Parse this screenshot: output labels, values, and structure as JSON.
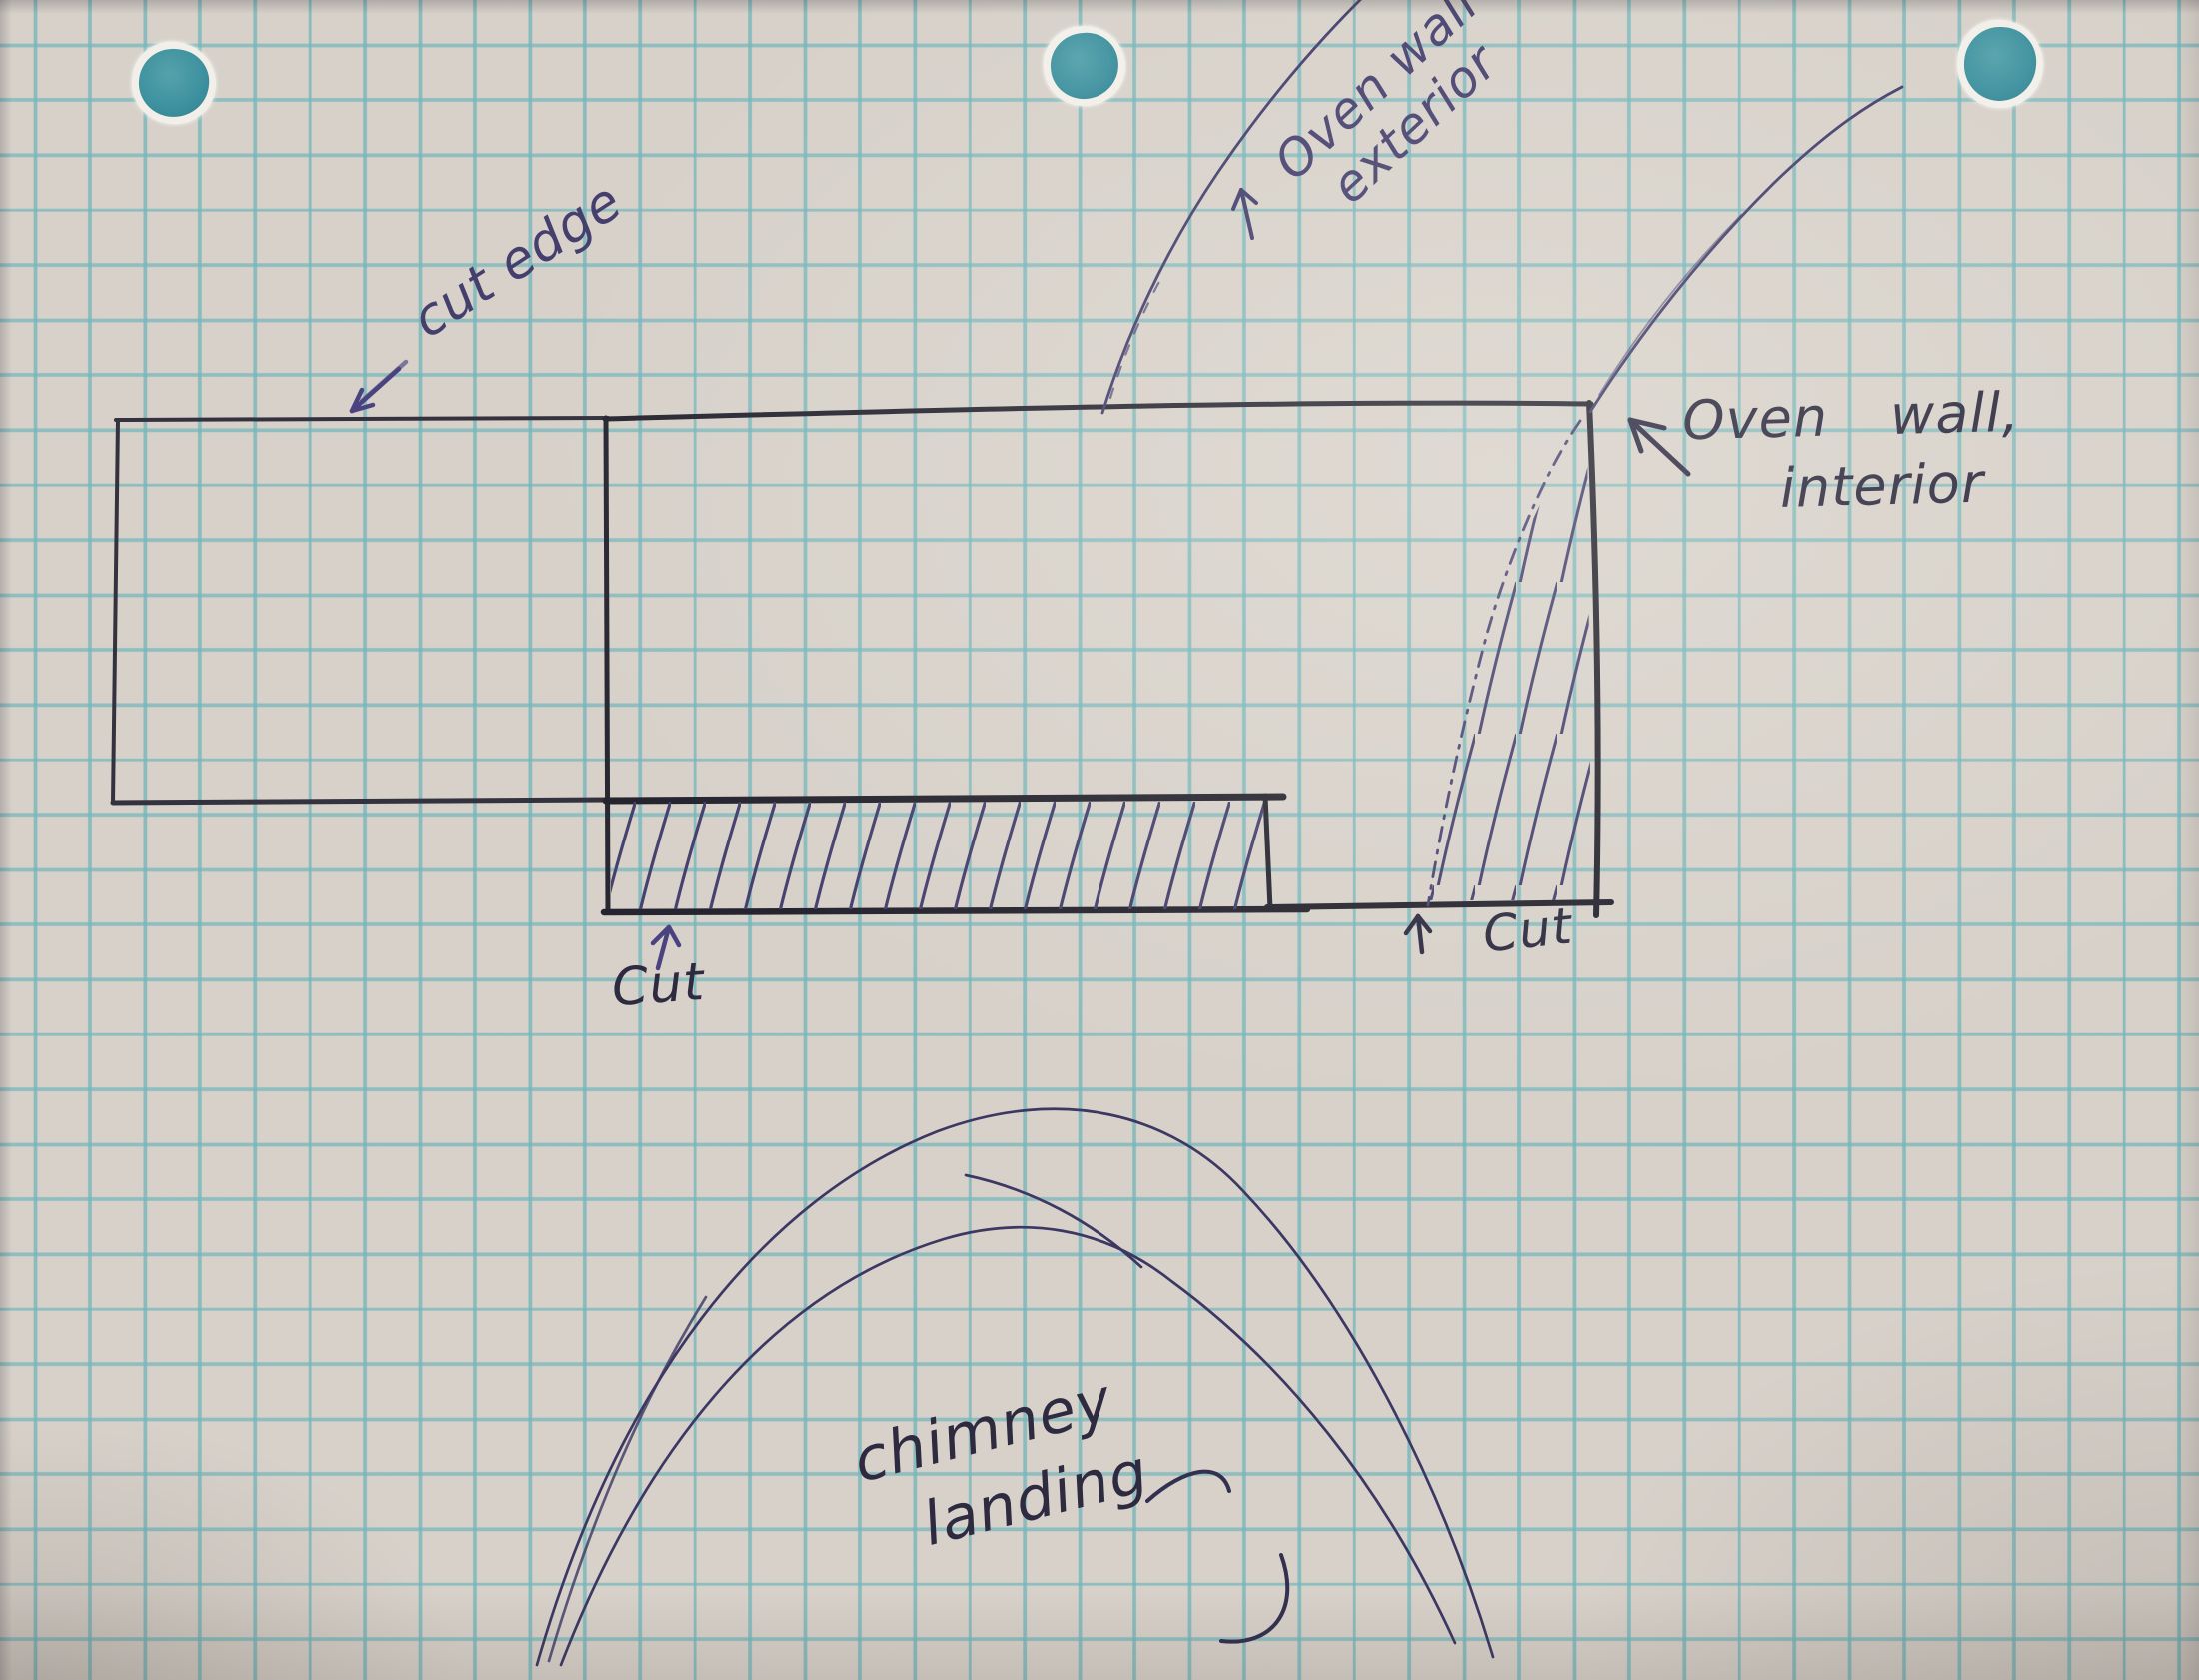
{
  "sketch": {
    "labels": {
      "cut_edge": "cut edge",
      "oven_wall_exterior": {
        "line1": "Oven wall",
        "line2": "exterior"
      },
      "oven_wall_interior": {
        "line1": "Oven wall,",
        "line2": "interior"
      },
      "cut_left": "Cut",
      "cut_right": "Cut",
      "chimney_landing": {
        "line1": "chimney",
        "line2": "landing"
      }
    },
    "colors": {
      "paper": "#d7d1ca",
      "grid_line": "#74b6bb",
      "ink_dark": "#2e2d36",
      "ink_blue": "#453f6e",
      "hole_teal": "#3f92a0"
    },
    "hole_punch_count": "3"
  }
}
